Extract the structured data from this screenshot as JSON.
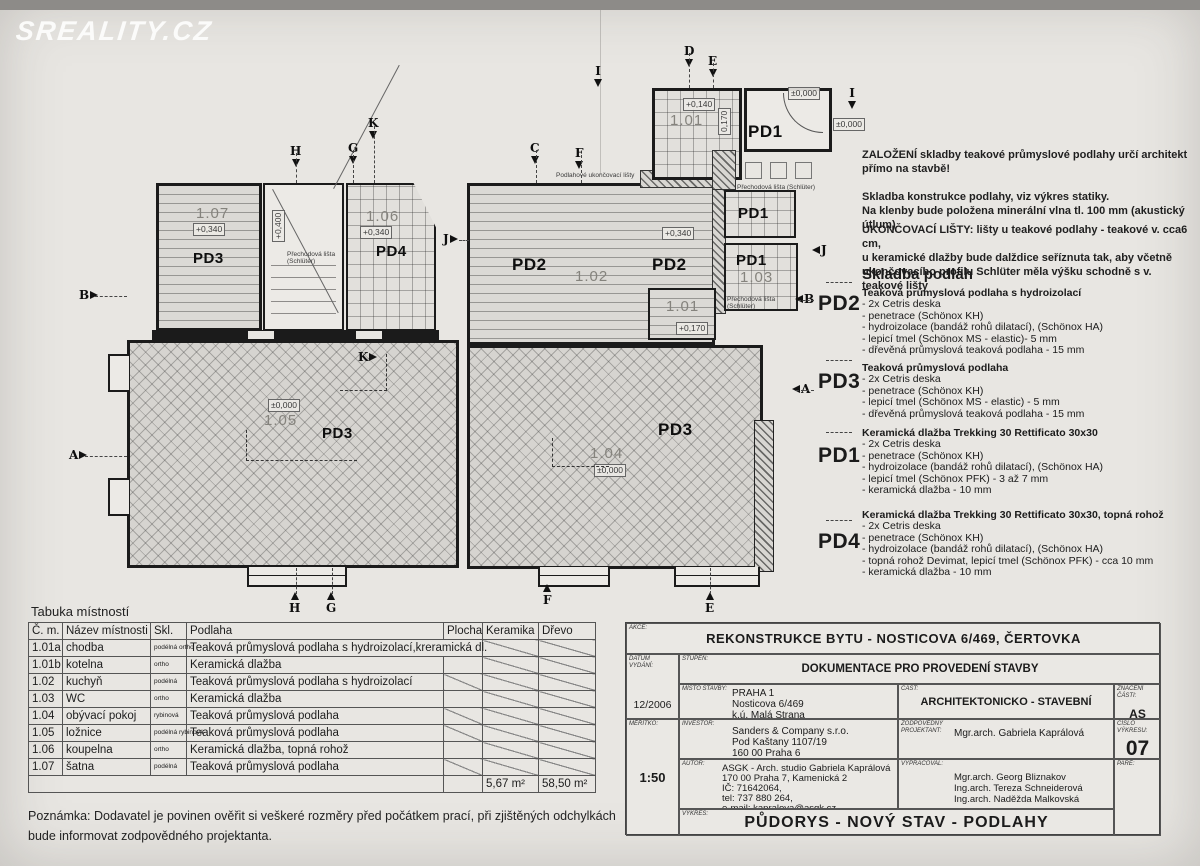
{
  "watermark": "SREALITY.CZ",
  "colors": {
    "paper": "#e8e6e2",
    "ink": "#1b1b1b",
    "muted_room_number": "#85837d"
  },
  "plan": {
    "codes": {
      "pd1": "PD1",
      "pd2": "PD2",
      "pd3": "PD3",
      "pd4": "PD4"
    },
    "rooms": {
      "r101": "1.01",
      "r102": "1.02",
      "r103": "1.03",
      "r104": "1.04",
      "r105": "1.05",
      "r106": "1.06",
      "r107": "1.07"
    },
    "elevations": {
      "zero": "±0,000",
      "p140": "+0,140",
      "p170": "+0,170",
      "p340": "+0,340",
      "p400": "+0,400",
      "d170": "0,170"
    },
    "callouts": {
      "finish_strip": "Podlahové ukončovací lišty",
      "transition_strip": "Přechodová lišta (Schlüter)"
    },
    "markers": {
      "a": "A",
      "b": "B",
      "c": "C",
      "d": "D",
      "e": "E",
      "f": "F",
      "g": "G",
      "h": "H",
      "i": "I",
      "j": "J",
      "k": "K"
    }
  },
  "notes_right": {
    "para1": "ZALOŽENÍ skladby teakové průmyslové podlahy určí architekt\npřímo na stavbě!",
    "para2": "Skladba konstrukce podlahy, viz výkres statiky.\nNa klenby bude položena minerální vlna tl. 100 mm (akustický útlum)",
    "para3": "UKONČOVACÍ LIŠTY: lišty u teakové podlahy - teakové v. cca6 cm,\nu keramické dlažby bude dalždice seříznuta tak, aby včetně\nukončovacího profilu Schlüter měla výšku schodně s v. teakové lišty"
  },
  "skladba": {
    "title": "Skladba podlah",
    "items": [
      {
        "code": "PD2",
        "name": "Teaková průmyslová podlaha s hydroizolací",
        "lines": "- 2x Cetris deska\n- penetrace (Schönox KH)\n- hydroizolace (bandáž rohů dilatací), (Schönox HA)\n- lepicí tmel (Schönox MS - elastic)- 5 mm\n- dřevěná průmyslová teaková podlaha - 15 mm"
      },
      {
        "code": "PD3",
        "name": "Teaková průmyslová podlaha",
        "lines": "- 2x Cetris deska\n- penetrace (Schönox KH)\n- lepicí tmel (Schönox MS - elastic) - 5 mm\n- dřevěná průmyslová teaková podlaha - 15 mm"
      },
      {
        "code": "PD1",
        "name": "Keramická dlažba Trekking 30 Rettificato 30x30",
        "lines": "- 2x Cetris deska\n- penetrace (Schönox KH)\n- hydroizolace (bandáž rohů dilatací), (Schönox HA)\n- lepicí tmel (Schönox PFK) - 3 až 7 mm\n- keramická dlažba - 10 mm"
      },
      {
        "code": "PD4",
        "name": "Keramická dlažba Trekking 30 Rettificato 30x30, topná rohož",
        "lines": "- 2x Cetris deska\n- penetrace (Schönox KH)\n- hydroizolace (bandáž rohů dilatací), (Schönox HA)\n- topná rohož Devimat, lepicí tmel (Schönox PFK) - cca 10 mm\n- keramická dlažba - 10 mm"
      }
    ]
  },
  "room_table": {
    "title": "Tabuka místností",
    "headers": [
      "Č. m.",
      "Název místnosti",
      "Skl.",
      "Podlaha",
      "Plocha",
      "Keramika",
      "Dřevo"
    ],
    "rows": [
      {
        "num": "1.01a",
        "name": "chodba",
        "skl": "podélná\northo",
        "floor": "Teaková průmyslová podlaha s hydroizolací,kreramická dl."
      },
      {
        "num": "1.01b",
        "name": "kotelna",
        "skl": "ortho",
        "floor": "Keramická dlažba"
      },
      {
        "num": "1.02",
        "name": "kuchyň",
        "skl": "podélná",
        "floor": "Teaková průmyslová podlaha s hydroizolací"
      },
      {
        "num": "1.03",
        "name": "WC",
        "skl": "ortho",
        "floor": "Keramická dlažba"
      },
      {
        "num": "1.04",
        "name": "obývací pokoj",
        "skl": "rybinová",
        "floor": "Teaková průmyslová podlaha"
      },
      {
        "num": "1.05",
        "name": "ložnice",
        "skl": "podélná\nrybinová",
        "floor": "Teaková průmyslová podlaha"
      },
      {
        "num": "1.06",
        "name": "koupelna",
        "skl": "ortho",
        "floor": "Keramická dlažba, topná rohož"
      },
      {
        "num": "1.07",
        "name": "šatna",
        "skl": "podélná",
        "floor": "Teaková průmyslová podlaha"
      }
    ],
    "totals": {
      "keramika": "5,67 m²",
      "drevo": "58,50 m²"
    }
  },
  "note_bottom": "Poznámka: Dodavatel je povinen ověřit si veškeré rozměry před počátkem prací, při zjištěných odchylkách\nbude informovat zodpovědného projektanta.",
  "title_block": {
    "akce_label": "AKCE:",
    "akce": "REKONSTRUKCE BYTU - NOSTICOVA 6/469, ČERTOVKA",
    "datum_label": "DATUM\nVYDÁNÍ:",
    "datum": "12/2006",
    "stupen_label": "STUPEŇ:",
    "stupen": "DOKUMENTACE PRO PROVEDENÍ STAVBY",
    "misto_label": "MÍSTO STAVBY:",
    "misto": "PRAHA 1\nNosticova 6/469\nk.ú. Malá Strana",
    "cast_label": "ČÁST:",
    "cast": "ARCHITEKTONICKO - STAVEBNÍ",
    "znaceni_label": "ZNAČENÍ\nČÁSTI:",
    "znaceni": "AS",
    "meritko_label": "MĚŘÍTKO:",
    "meritko": "1:50",
    "investor_label": "INVESTOR:",
    "investor": "Sanders & Company s.r.o.\nPod Kaštany 1107/19\n160 00 Praha 6",
    "zodp_label": "ZODPOVĚDNÝ\nPROJEKTANT:",
    "zodp": "Mgr.arch. Gabriela Kaprálová",
    "cislo_label": "ČÍSLO\nVÝKRESU:",
    "cislo": "07",
    "autor_label": "AUTOR:",
    "autor": "ASGK - Arch. studio Gabriela Kaprálová\n170 00 Praha 7, Kamenická 2\nIČ: 71642064,\ntel: 737 880 264,\ne-mail: kapralova@asgk.cz",
    "vypracoval_label": "VYPRACOVAL:",
    "vypracoval": "Mgr.arch. Georg Bliznakov\nIng.arch. Tereza Schneiderová\nIng.arch. Naděžda Malkovská",
    "pare_label": "PARÉ:",
    "vykres_label": "VÝKRES:",
    "vykres": "PŮDORYS - NOVÝ STAV - PODLAHY"
  }
}
